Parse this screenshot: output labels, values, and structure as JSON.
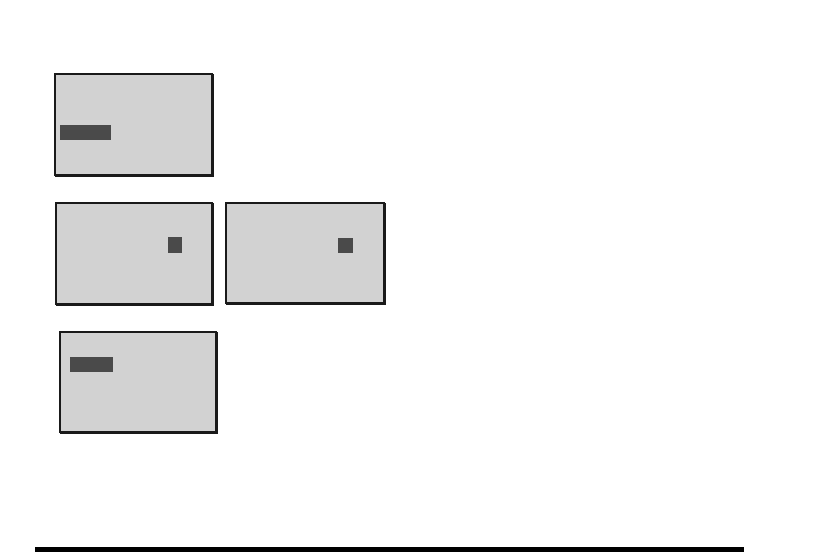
{
  "page": {
    "background": "#ffffff"
  },
  "colors": {
    "figure_fill": "#d2d2d2",
    "figure_border": "#1a1a1a",
    "figure_mark": "#4a4a4a",
    "footer_rule": "#000000"
  },
  "figures": [
    {
      "id": "figure-1",
      "mark_shape": "horizontal-bar",
      "mark_position": "left-middle"
    },
    {
      "id": "figure-2",
      "mark_shape": "small-square",
      "mark_position": "right-of-center-upper"
    },
    {
      "id": "figure-3",
      "mark_shape": "small-square",
      "mark_position": "right-of-center-upper"
    },
    {
      "id": "figure-4",
      "mark_shape": "horizontal-bar",
      "mark_position": "left-upper"
    }
  ],
  "footer": {
    "rule": "thick-horizontal-rule"
  }
}
